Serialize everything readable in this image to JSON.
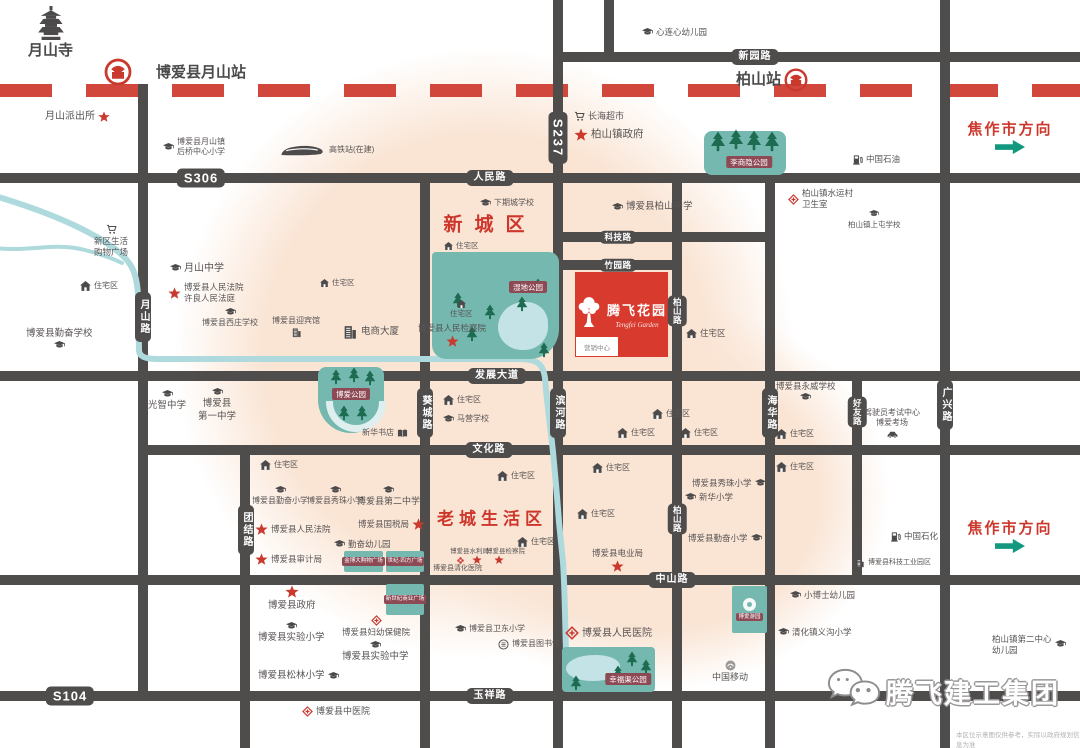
{
  "colors": {
    "road": "#4f4c4c",
    "railway_red": "#d1473c",
    "accent_red": "#cd372b",
    "park_teal": "#74b8af",
    "tree_green": "#1d6b50",
    "badge_maroon": "#8d4a55",
    "river_blue": "#aedadd",
    "blob_peach": "#fae5d5",
    "arrow_green": "#12987f",
    "project_red": "#d93a2e",
    "text_gray": "#585454"
  },
  "project": {
    "name": "腾飞花园",
    "en": "Tengfei Garden",
    "sales_office": "营销中心"
  },
  "corner": {
    "brand": "腾飞建工集团",
    "disclaimer": "本区位示意图仅供参考，实际以政府规划信息为准"
  },
  "map": {
    "railway": {
      "y": 84,
      "color": "#d1473c"
    },
    "roads_h": [
      {
        "name": "新园路",
        "x": 558,
        "y": 52,
        "len": 522
      },
      {
        "name": "人民路-S306",
        "x": 0,
        "y": 173,
        "len": 1080
      },
      {
        "name": "科技路",
        "x": 558,
        "y": 232,
        "len": 212
      },
      {
        "name": "竹园路",
        "x": 558,
        "y": 260,
        "len": 119
      },
      {
        "name": "发展大道",
        "x": 0,
        "y": 371,
        "len": 1080
      },
      {
        "name": "文化路",
        "x": 143,
        "y": 445,
        "len": 937
      },
      {
        "name": "中山路",
        "x": 0,
        "y": 575,
        "len": 1080
      },
      {
        "name": "玉祥路-S104",
        "x": 0,
        "y": 691,
        "len": 1080
      }
    ],
    "roads_v": [
      {
        "name": "月山路",
        "x": 138,
        "y": 84,
        "len": 612
      },
      {
        "name": "团结路",
        "x": 240,
        "y": 445,
        "len": 303
      },
      {
        "name": "葵城路",
        "x": 420,
        "y": 173,
        "len": 575
      },
      {
        "name": "S237-滨河路",
        "x": 553,
        "y": 0,
        "len": 748
      },
      {
        "name": "北支路",
        "x": 604,
        "y": 0,
        "len": 57
      },
      {
        "name": "柏山路",
        "x": 672,
        "y": 173,
        "len": 575
      },
      {
        "name": "海华路",
        "x": 765,
        "y": 173,
        "len": 575
      },
      {
        "name": "好友路",
        "x": 852,
        "y": 371,
        "len": 209
      },
      {
        "name": "广兴路",
        "x": 940,
        "y": 0,
        "len": 748
      }
    ],
    "badges": [
      {
        "label": "S306",
        "x": 201,
        "y": 178,
        "big": true
      },
      {
        "label": "人民路",
        "x": 490,
        "y": 178
      },
      {
        "label": "新园路",
        "x": 755,
        "y": 57
      },
      {
        "label": "科技路",
        "x": 618,
        "y": 237,
        "small": true
      },
      {
        "label": "竹园路",
        "x": 618,
        "y": 265,
        "small": true
      },
      {
        "label": "发展大道",
        "x": 497,
        "y": 376
      },
      {
        "label": "文化路",
        "x": 489,
        "y": 450
      },
      {
        "label": "中山路",
        "x": 672,
        "y": 580
      },
      {
        "label": "玉祥路",
        "x": 490,
        "y": 696
      },
      {
        "label": "S104",
        "x": 70,
        "y": 696,
        "big": true
      },
      {
        "label": "S237",
        "x": 558,
        "y": 138,
        "v": true,
        "big": true
      },
      {
        "label": "月山路",
        "x": 143,
        "y": 317,
        "v": true
      },
      {
        "label": "葵城路",
        "x": 425,
        "y": 413,
        "v": true
      },
      {
        "label": "滨河路",
        "x": 558,
        "y": 413,
        "v": true
      },
      {
        "label": "海华路",
        "x": 770,
        "y": 413,
        "v": true
      },
      {
        "label": "好友路",
        "x": 857,
        "y": 412,
        "v": true,
        "small": true
      },
      {
        "label": "广兴路",
        "x": 945,
        "y": 405,
        "v": true
      },
      {
        "label": "团结路",
        "x": 246,
        "y": 530,
        "v": true
      },
      {
        "label": "柏山路",
        "x": 677,
        "y": 311,
        "v": true,
        "small": true
      },
      {
        "label": "柏山路",
        "x": 677,
        "y": 519,
        "v": true,
        "small": true
      }
    ],
    "districts": [
      {
        "label": "新城区",
        "x": 490,
        "y": 223,
        "size": 19,
        "ls": 12
      },
      {
        "label": "老城生活区",
        "x": 492,
        "y": 517,
        "size": 17,
        "ls": 5
      }
    ],
    "directions": [
      {
        "label": "焦作市方向",
        "x": 1010,
        "y": 118,
        "arrowY": 140
      },
      {
        "label": "焦作市方向",
        "x": 1010,
        "y": 517,
        "arrowY": 539
      }
    ],
    "parks": [
      {
        "name": "李商隐公园",
        "x": 704,
        "y": 131,
        "w": 82,
        "h": 44,
        "r": "8px",
        "treeSize": 16,
        "trees": [
          {
            "x": 6,
            "y": 0
          },
          {
            "x": 24,
            "y": -2
          },
          {
            "x": 42,
            "y": -1
          },
          {
            "x": 60,
            "y": 0
          }
        ],
        "badge": {
          "x": 45,
          "y": 31,
          "label": "李商隐公园"
        }
      },
      {
        "name": "湿地公园",
        "x": 432,
        "y": 252,
        "w": 127,
        "h": 107,
        "r": "4px 10px 30px 14px",
        "treeSize": 12,
        "pond": {
          "x": 66,
          "y": 50,
          "w": 50,
          "h": 48
        },
        "trees": [
          {
            "x": 20,
            "y": 40
          },
          {
            "x": 52,
            "y": 52
          },
          {
            "x": 84,
            "y": 44
          },
          {
            "x": 34,
            "y": 74
          },
          {
            "x": 100,
            "y": 26
          },
          {
            "x": 106,
            "y": 90
          }
        ],
        "badge": {
          "x": 96,
          "y": 35,
          "label": "湿地公园"
        }
      },
      {
        "name": "博爱公园",
        "x": 318,
        "y": 367,
        "w": 66,
        "h": 66,
        "r": "8px 8px 33px 33px",
        "treeSize": 12,
        "crescent": {
          "x": 8,
          "y": 34,
          "w": 46,
          "h": 24
        },
        "trees": [
          {
            "x": 12,
            "y": 2
          },
          {
            "x": 30,
            "y": 0
          },
          {
            "x": 46,
            "y": 3
          },
          {
            "x": 20,
            "y": 38
          },
          {
            "x": 38,
            "y": 38
          }
        ],
        "badge": {
          "x": 33,
          "y": 27,
          "label": "博爱公园"
        }
      },
      {
        "name": "幸福渠公园",
        "x": 562,
        "y": 647,
        "w": 93,
        "h": 45,
        "r": "4px",
        "treeSize": 12,
        "pond": {
          "x": 4,
          "y": 8,
          "w": 54,
          "h": 26
        },
        "trees": [
          {
            "x": 64,
            "y": 4
          },
          {
            "x": 78,
            "y": 12
          },
          {
            "x": 50,
            "y": 18
          },
          {
            "x": 8,
            "y": 28
          }
        ],
        "badge": {
          "x": 66,
          "y": 32,
          "label": "幸福渠公园"
        }
      }
    ],
    "plazas": [
      {
        "label": "金博大购物广场",
        "x": 344,
        "y": 551,
        "w": 39,
        "h": 21
      },
      {
        "label": "世纪·四方广场",
        "x": 386,
        "y": 551,
        "w": 38,
        "h": 21
      },
      {
        "label": "新世纪商业广场",
        "x": 386,
        "y": 584,
        "w": 38,
        "h": 31
      },
      {
        "label": "博爱游园",
        "x": 732,
        "y": 586,
        "w": 35,
        "h": 47,
        "logo": true
      }
    ],
    "pois": [
      {
        "label": "月山寺",
        "icon": "pagoda-icon",
        "iconPos": "top",
        "x": 28,
        "y": 6,
        "size": 15,
        "bold": true,
        "iconSize": 30
      },
      {
        "label": "",
        "icon": "railway-logo-icon",
        "x": 104,
        "y": 58,
        "iconSize": 28
      },
      {
        "label": "博爱县月山站",
        "x": 156,
        "y": 63,
        "size": 15,
        "bold": true
      },
      {
        "label": "月山派出所",
        "icon": "star-icon",
        "iconPos": "right",
        "x": 45,
        "y": 110,
        "size": 10,
        "iconSize": 12
      },
      {
        "label": "博爱县月山镇",
        "label2": "后桥中心小学",
        "icon": "school-icon",
        "x": 163,
        "y": 137,
        "size": 8
      },
      {
        "label": "高铁站(在建)",
        "icon": "train-icon",
        "x": 280,
        "y": 143,
        "size": 8,
        "iconSize": 46
      },
      {
        "label": "新区生活",
        "label2": "购物广场",
        "icon": "cart-icon",
        "iconPos": "top",
        "x": 94,
        "y": 224,
        "size": 8.5
      },
      {
        "label": "月山中学",
        "icon": "school-icon",
        "x": 170,
        "y": 262,
        "size": 10
      },
      {
        "label": "博爱县人民法院",
        "label2": "许良人民法庭",
        "icon": "star-icon",
        "x": 168,
        "y": 282,
        "size": 8.5,
        "iconSize": 13
      },
      {
        "label": "住宅区",
        "icon": "house-icon",
        "x": 80,
        "y": 281,
        "size": 8
      },
      {
        "label": "博爱县勤奋学校",
        "icon": "school-icon",
        "iconPos": "bottom",
        "x": 26,
        "y": 328,
        "size": 9.5
      },
      {
        "label": "博爱县西庄学校",
        "icon": "school-icon",
        "iconPos": "top",
        "x": 202,
        "y": 308,
        "size": 8
      },
      {
        "label": "博爱县迎宾馆",
        "icon": "building-icon",
        "iconPos": "bottom",
        "x": 272,
        "y": 316,
        "size": 8
      },
      {
        "label": "电商大厦",
        "icon": "building-icon",
        "x": 342,
        "y": 324,
        "size": 9.5,
        "iconSize": 16
      },
      {
        "label": "住宅区",
        "icon": "house-icon",
        "x": 320,
        "y": 278,
        "size": 7.5,
        "iconSize": 9
      },
      {
        "label": "心连心幼儿园",
        "icon": "school-icon",
        "x": 642,
        "y": 27,
        "size": 8.5
      },
      {
        "label": "长海超市",
        "icon": "cart-icon",
        "x": 574,
        "y": 111,
        "size": 9
      },
      {
        "label": "柏山镇政府",
        "icon": "star-icon",
        "x": 574,
        "y": 128,
        "size": 10.5,
        "iconSize": 14
      },
      {
        "label": "柏山站",
        "icon": "railway-logo-icon",
        "iconPos": "right",
        "x": 736,
        "y": 68,
        "size": 15,
        "bold": true,
        "iconSize": 24
      },
      {
        "label": "中国石油",
        "icon": "fuel-icon",
        "x": 852,
        "y": 154,
        "size": 8.5
      },
      {
        "label": "柏山镇水运村",
        "label2": "卫生室",
        "icon": "clinic-icon",
        "x": 788,
        "y": 188,
        "size": 8.5
      },
      {
        "label": "柏山镇上屯学校",
        "icon": "school-icon",
        "iconPos": "top",
        "x": 848,
        "y": 210,
        "size": 7.5,
        "iconSize": 10
      },
      {
        "label": "博爱县柏山中学",
        "icon": "school-icon",
        "x": 612,
        "y": 201,
        "size": 9.5
      },
      {
        "label": "下期城学校",
        "icon": "school-icon",
        "x": 480,
        "y": 198,
        "size": 8
      },
      {
        "label": "住宅区",
        "icon": "house-icon",
        "x": 444,
        "y": 241,
        "size": 7.5,
        "iconSize": 9
      },
      {
        "label": "博爱县人民检察院",
        "icon": "star-icon",
        "iconPos": "bottom",
        "x": 418,
        "y": 323,
        "size": 8.5,
        "iconSize": 13
      },
      {
        "label": "住宅区",
        "icon": "house-icon",
        "iconPos": "top",
        "x": 450,
        "y": 300,
        "size": 7.5,
        "iconSize": 9
      },
      {
        "label": "住宅区",
        "icon": "house-icon",
        "x": 686,
        "y": 328,
        "size": 8.5
      },
      {
        "label": "光智中学",
        "icon": "school-icon",
        "iconPos": "top",
        "x": 148,
        "y": 390,
        "size": 9.5
      },
      {
        "label": "博爱县",
        "label2": "第一中学",
        "icon": "school-icon",
        "iconPos": "top",
        "x": 198,
        "y": 388,
        "size": 9.5
      },
      {
        "label": "新华书店",
        "icon": "book-icon",
        "iconPos": "right",
        "x": 362,
        "y": 428,
        "size": 8
      },
      {
        "label": "住宅区",
        "icon": "house-icon",
        "x": 443,
        "y": 395,
        "size": 8
      },
      {
        "label": "马营学校",
        "icon": "school-icon",
        "x": 443,
        "y": 414,
        "size": 8
      },
      {
        "label": "住宅区",
        "icon": "house-icon",
        "x": 652,
        "y": 409,
        "size": 8
      },
      {
        "label": "住宅区",
        "icon": "house-icon",
        "x": 617,
        "y": 428,
        "size": 8
      },
      {
        "label": "住宅区",
        "icon": "house-icon",
        "x": 680,
        "y": 428,
        "size": 8
      },
      {
        "label": "住宅区",
        "icon": "house-icon",
        "x": 592,
        "y": 463,
        "size": 8
      },
      {
        "label": "住宅区",
        "icon": "house-icon",
        "x": 497,
        "y": 471,
        "size": 8
      },
      {
        "label": "博爱县永威学校",
        "icon": "school-icon",
        "iconPos": "bottom",
        "x": 776,
        "y": 381,
        "size": 8.5
      },
      {
        "label": "驾驶员考试中心",
        "label2": "博爱考场",
        "icon": "car-icon",
        "iconPos": "bottom",
        "x": 864,
        "y": 408,
        "size": 8
      },
      {
        "label": "住宅区",
        "icon": "house-icon",
        "x": 776,
        "y": 429,
        "size": 8
      },
      {
        "label": "住宅区",
        "icon": "house-icon",
        "x": 776,
        "y": 462,
        "size": 8
      },
      {
        "label": "博爱县秀珠小学",
        "icon": "school-icon",
        "iconPos": "right",
        "x": 692,
        "y": 478,
        "size": 8.5
      },
      {
        "label": "新华小学",
        "icon": "school-icon",
        "x": 685,
        "y": 492,
        "size": 8.5
      },
      {
        "label": "博爱县勤奋小学",
        "icon": "school-icon",
        "iconPos": "right",
        "x": 688,
        "y": 533,
        "size": 8.5
      },
      {
        "label": "住宅区",
        "icon": "house-icon",
        "x": 260,
        "y": 460,
        "size": 8
      },
      {
        "label": "博爱县勤奋小学",
        "icon": "school-icon",
        "iconPos": "top",
        "x": 252,
        "y": 486,
        "size": 8
      },
      {
        "label": "博爱县秀珠小学",
        "icon": "school-icon",
        "iconPos": "top",
        "x": 307,
        "y": 486,
        "size": 8
      },
      {
        "label": "博爱县第二中学",
        "icon": "school-icon",
        "iconPos": "top",
        "x": 357,
        "y": 486,
        "size": 9
      },
      {
        "label": "博爱县人民法院",
        "icon": "star-icon",
        "x": 255,
        "y": 523,
        "size": 8.5,
        "iconSize": 13
      },
      {
        "label": "博爱县国税局",
        "icon": "star-icon",
        "iconPos": "right",
        "x": 358,
        "y": 518,
        "size": 8.5,
        "iconSize": 13
      },
      {
        "label": "勤奋幼儿园",
        "icon": "school-icon",
        "x": 334,
        "y": 539,
        "size": 8.5
      },
      {
        "label": "博爱县审计局",
        "icon": "star-icon",
        "x": 255,
        "y": 553,
        "size": 8.5,
        "iconSize": 13
      },
      {
        "label": "博爱县政府",
        "icon": "star-icon",
        "iconPos": "top",
        "x": 268,
        "y": 585,
        "size": 9.5,
        "iconSize": 14
      },
      {
        "label": "博爱县实验小学",
        "icon": "school-icon",
        "iconPos": "top",
        "x": 258,
        "y": 622,
        "size": 9.5
      },
      {
        "label": "博爱县妇幼保健院",
        "icon": "clinic-icon",
        "iconPos": "top",
        "x": 342,
        "y": 615,
        "size": 8.5
      },
      {
        "label": "博爱县实验中学",
        "icon": "school-icon",
        "iconPos": "top",
        "x": 342,
        "y": 641,
        "size": 9.5
      },
      {
        "label": "博爱县松林小学",
        "icon": "school-icon",
        "iconPos": "right",
        "x": 258,
        "y": 670,
        "size": 9.5
      },
      {
        "label": "博爱县中医院",
        "icon": "clinic-icon",
        "x": 302,
        "y": 706,
        "size": 9
      },
      {
        "label": "博爱县卫东小学",
        "icon": "school-icon",
        "x": 455,
        "y": 624,
        "size": 8
      },
      {
        "label": "博爱县图书馆",
        "icon": "library-icon",
        "x": 498,
        "y": 639,
        "size": 8
      },
      {
        "label": "博爱县人民医院",
        "icon": "clinic-icon",
        "x": 565,
        "y": 626,
        "size": 10,
        "iconSize": 14
      },
      {
        "label": "中国移动",
        "icon": "mobile-icon",
        "iconPos": "top",
        "x": 712,
        "y": 660,
        "size": 9
      },
      {
        "label": "清化镇义沟小学",
        "icon": "school-icon",
        "x": 778,
        "y": 627,
        "size": 8.5
      },
      {
        "label": "小博士幼儿园",
        "icon": "school-icon",
        "x": 790,
        "y": 590,
        "size": 8.5
      },
      {
        "label": "柏山镇第二中心",
        "label2": "幼儿园",
        "icon": "school-icon",
        "iconPos": "right",
        "x": 992,
        "y": 634,
        "size": 8.5
      },
      {
        "label": "中国石化",
        "icon": "fuel-icon",
        "x": 890,
        "y": 531,
        "size": 8.5
      },
      {
        "label": "博爱县科技工业园区",
        "icon": "building-icon",
        "x": 855,
        "y": 558,
        "size": 7,
        "iconSize": 10
      },
      {
        "label": "博爱县电业局",
        "icon": "star-icon",
        "iconPos": "bottom",
        "x": 592,
        "y": 548,
        "size": 8.5,
        "iconSize": 13
      },
      {
        "label": "住宅区",
        "icon": "house-icon",
        "x": 577,
        "y": 509,
        "size": 8
      },
      {
        "label": "住宅区",
        "icon": "house-icon",
        "x": 517,
        "y": 537,
        "size": 8
      },
      {
        "label": "博爱县水利局",
        "x": 450,
        "y": 548,
        "size": 6.5
      },
      {
        "label": "博爱县检察院",
        "x": 486,
        "y": 548,
        "size": 6.5
      },
      {
        "label": "",
        "icon": "flower-icon",
        "x": 456,
        "y": 556,
        "iconSize": 9
      },
      {
        "label": "",
        "icon": "star-icon",
        "x": 472,
        "y": 555,
        "iconSize": 10
      },
      {
        "label": "",
        "icon": "star-icon",
        "x": 494,
        "y": 555,
        "iconSize": 10
      },
      {
        "label": "博爱县清化医院",
        "x": 433,
        "y": 564,
        "size": 7
      }
    ]
  }
}
